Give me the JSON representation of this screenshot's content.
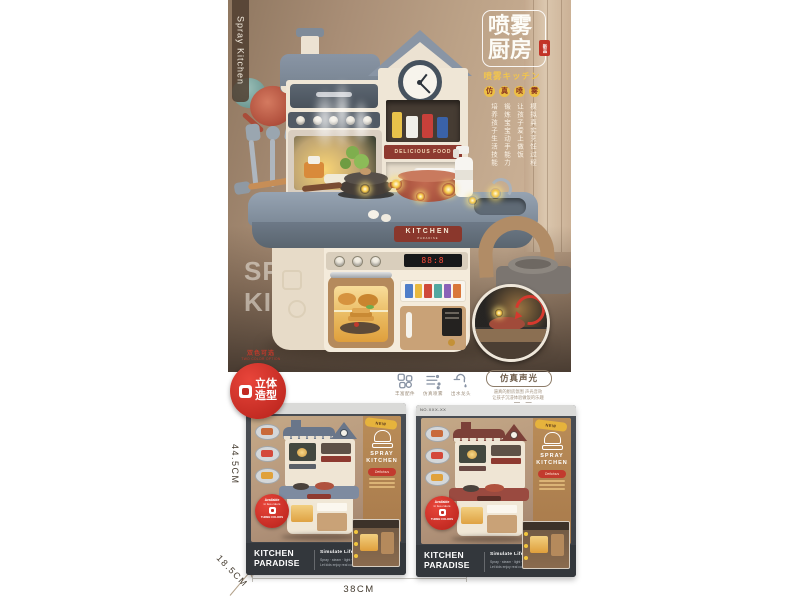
{
  "photo": {
    "side_tag": "Spray Kitchen",
    "title": {
      "line1": "喷雾",
      "line2": "厨房",
      "seal": "新品",
      "subtitle": "喷雾キッチン",
      "badges": [
        "仿",
        "真",
        "喷",
        "雾"
      ],
      "sell_points": [
        "模拟真实烹饪过程",
        "让孩子爱上做饭",
        "锻炼宝宝动手能力",
        "培养孩子生活技能"
      ]
    },
    "watermark": {
      "line1": "SPRAY",
      "line2": "KITCHEN"
    },
    "signs": {
      "delicious": "DELICIOUS FOOD",
      "kitchen": "KITCHEN",
      "kitchen_sub": "PARADISE",
      "oven_display": "88:8"
    },
    "two_color": {
      "top": "双色可选",
      "en": "TWO COLOR OPTION",
      "badge_top": "立体",
      "badge_bottom": "造型"
    }
  },
  "features": {
    "icons": [
      {
        "name": "accessories-icon",
        "label": "丰富配件"
      },
      {
        "name": "spray-icon",
        "label": "仿真喷雾"
      },
      {
        "name": "faucet-icon",
        "label": "出水龙头"
      }
    ],
    "stadium": "仿真声光",
    "desc1": "逼真的厨房氛围 声光音效",
    "desc2": "让孩子沉浸体验做饭的乐趣",
    "dashes": "— —"
  },
  "dimensions": {
    "height": "44.5CM",
    "width": "38CM",
    "depth": "18.5CM"
  },
  "boxes": [
    {
      "no": "NO.XXX-XX",
      "ribbon": "NEW",
      "accent": "#7e8ba0",
      "roof": "#69768a",
      "logo1": "SPRAY",
      "logo2": "KITCHEN",
      "logo_ribbon": "Delicious",
      "badge_l1": "Available",
      "badge_l2": "in two colors",
      "badge_l3": "THREE COLORS",
      "brand1": "KITCHEN",
      "brand2": "PARADISE",
      "slogan": "Simulate Life Scenarios",
      "sub1": "Spray · steam · light · sound effects",
      "sub2": "Let kids enjoy real cooking fun"
    },
    {
      "no": "NO.XXX-XX",
      "ribbon": "NEW",
      "accent": "#9a4a40",
      "roof": "#7b4038",
      "logo1": "SPRAY",
      "logo2": "KITCHEN",
      "logo_ribbon": "Delicious",
      "badge_l1": "Available",
      "badge_l2": "in two colors",
      "badge_l3": "THREE COLORS",
      "brand1": "KITCHEN",
      "brand2": "PARADISE",
      "slogan": "Simulate Life Scenarios",
      "sub1": "Spray · steam · light · sound effects",
      "sub2": "Let kids enjoy real cooking fun"
    }
  ]
}
